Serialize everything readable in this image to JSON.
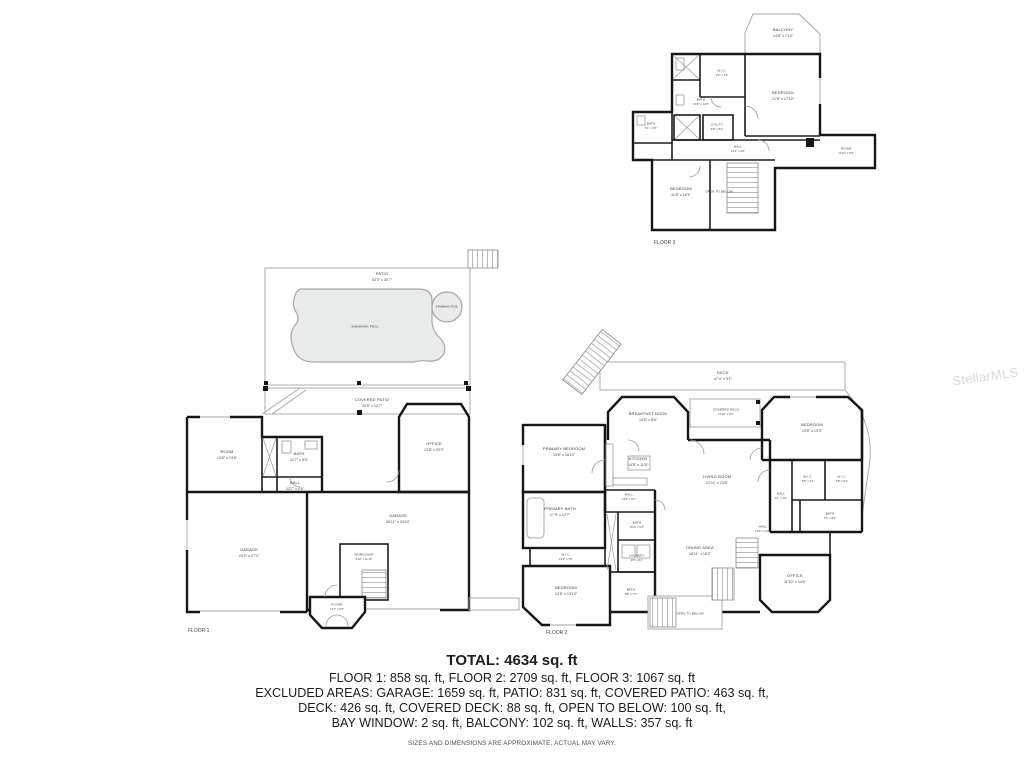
{
  "watermark": "StellarMLS",
  "summary": {
    "total": "TOTAL: 4634 sq. ft",
    "line1": "FLOOR 1: 858 sq. ft, FLOOR 2: 2709 sq. ft, FLOOR 3: 1067 sq. ft",
    "line2": "EXCLUDED AREAS: GARAGE: 1659 sq. ft, PATIO: 831 sq. ft, COVERED PATIO: 463 sq. ft,",
    "line3": "DECK: 426 sq. ft, COVERED DECK: 88 sq. ft, OPEN TO BELOW: 100 sq. ft,",
    "line4": "BAY WINDOW: 2 sq. ft, BALCONY: 102 sq. ft, WALLS: 357 sq. ft",
    "disclaimer": "SIZES AND DIMENSIONS ARE APPROXIMATE, ACTUAL MAY VARY."
  },
  "floors": {
    "floor1": {
      "caption": "FLOOR 1",
      "rooms": [
        {
          "name": "PATIO",
          "dims": "53'3\" x 30'7\""
        },
        {
          "name": "SWIMMING POOL",
          "dims": ""
        },
        {
          "name": "SWIMMING POOL",
          "dims": ""
        },
        {
          "name": "COVERED PATIO",
          "dims": "40'5\" x 12'7\""
        },
        {
          "name": "ROOM",
          "dims": "13'8\" x 13'6\""
        },
        {
          "name": "BATH",
          "dims": "12'7\" x 8'5\""
        },
        {
          "name": "HALL",
          "dims": "12'7\" x 4'6\""
        },
        {
          "name": "OFFICE",
          "dims": "13'8\" x 20'2\""
        },
        {
          "name": "GARAGE",
          "dims": "23'5\" x 27'4\""
        },
        {
          "name": "GARAGE",
          "dims": "36'11\" x 34'10\""
        },
        {
          "name": "WORKSHOP",
          "dims": "9'10\" x 11'10\""
        },
        {
          "name": "FOYER",
          "dims": "11'3\" x 5'9\""
        }
      ]
    },
    "floor2": {
      "caption": "FLOOR 2",
      "rooms": [
        {
          "name": "DECK",
          "dims": "47'4\" x 5'1\""
        },
        {
          "name": "BREAKFAST NOOK",
          "dims": "14'8\" x 8'6\""
        },
        {
          "name": "COVERED DECK",
          "dims": "17'10\" x 5'1\""
        },
        {
          "name": "BEDROOM",
          "dims": "13'8\" x 13'3\""
        },
        {
          "name": "PRIMARY BEDROOM",
          "dims": "19'8\" x 16'10\""
        },
        {
          "name": "KITCHEN",
          "dims": "14'8\" x 11'8\""
        },
        {
          "name": "LIVING ROOM",
          "dims": "22'11\" x 23'8\""
        },
        {
          "name": "PRIMARY BATH",
          "dims": "17'9\" x 12'7\""
        },
        {
          "name": "W.I.C.",
          "dims": "13'8\" x 4'5\""
        },
        {
          "name": "HALL",
          "dims": "13'8\" x 3'1\""
        },
        {
          "name": "BATH",
          "dims": "5'10\" x 5'3\""
        },
        {
          "name": "LAUNDRY",
          "dims": "9'8\" x 8'1\""
        },
        {
          "name": "DINING AREA",
          "dims": "18'11\" x 18'2\""
        },
        {
          "name": "HALL",
          "dims": "14'8\" x 12'5\""
        },
        {
          "name": "BEDROOM",
          "dims": "13'8\" x 13'10\""
        },
        {
          "name": "BATH",
          "dims": "8'8\" x 7'7\""
        },
        {
          "name": "HALL",
          "dims": "3'1\" x 7'0\""
        },
        {
          "name": "W.I.C.",
          "dims": "3'8\" x 6'1\""
        },
        {
          "name": "W.I.C.",
          "dims": "3'8\" x 6'1\""
        },
        {
          "name": "BATH",
          "dims": "5'5\" x 8'4\""
        },
        {
          "name": "OFFICE",
          "dims": "11'10\" x 14'5\""
        },
        {
          "name": "OPEN TO BELOW",
          "dims": ""
        }
      ]
    },
    "floor3": {
      "caption": "FLOOR 3",
      "rooms": [
        {
          "name": "BALCONY",
          "dims": "14'8\" x 7'10\""
        },
        {
          "name": "BEDROOM",
          "dims": "21'8\" x 17'10\""
        },
        {
          "name": "W.I.C.",
          "dims": "9'0\" x 4'9\""
        },
        {
          "name": "BATH",
          "dims": "13'8\" x 12'8\""
        },
        {
          "name": "BATH",
          "dims": "6'1\" x 5'6\""
        },
        {
          "name": "UTILITY",
          "dims": "5'8\" x 5'4\""
        },
        {
          "name": "HALL",
          "dims": "12'2\" x 4'9\""
        },
        {
          "name": "ROOM",
          "dims": "11'10\" x 6'9\""
        },
        {
          "name": "BEDROOM",
          "dims": "11'8\" x 16'1\""
        },
        {
          "name": "OPEN TO BELOW",
          "dims": ""
        }
      ]
    }
  }
}
